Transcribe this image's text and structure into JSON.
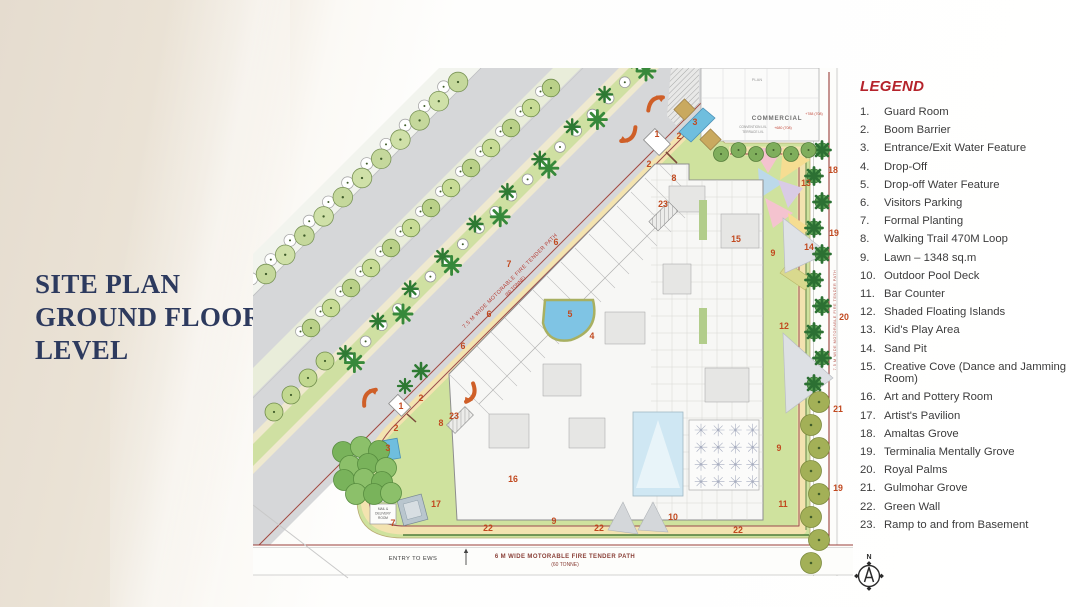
{
  "title": {
    "lines": [
      "SITE PLAN",
      "GROUND FLOOR",
      "LEVEL"
    ]
  },
  "legend": {
    "title": "LEGEND",
    "items": [
      "Guard Room",
      "Boom Barrier",
      "Entrance/Exit Water Feature",
      "Drop-Off",
      "Drop-off Water Feature",
      "Visitors Parking",
      "Formal Planting",
      "Walking Trail 470M Loop",
      "Lawn – 1348 sq.m",
      "Outdoor Pool Deck",
      "Bar Counter",
      "Shaded Floating Islands",
      "Kid's Play Area",
      "Sand Pit",
      "Creative Cove (Dance and Jamming Room)",
      "Art and Pottery Room",
      "Artist's Pavilion",
      "Amaltas Grove",
      "Terminalia Mentally Grove",
      "Royal Palms",
      "Gulmohar Grove",
      "Green Wall",
      "Ramp to and from Basement"
    ]
  },
  "plan": {
    "annotations": {
      "commercial": "COMMERCIAL",
      "convention": "CONVENTION LVL",
      "terrace": "TERRACE LVL",
      "plan_small": "PLAN",
      "elev_1": "+788 (708)",
      "elev_2": "+680 (708)",
      "fire_diag_1": "7.5 M WIDE MOTORABLE FIRE TENDER PATH",
      "fire_diag_2": "(60 TONNE)",
      "fire_right": "7.5 M WIDE MOTORABLE FIRE TENDER PATH",
      "fire_bottom_1": "6 M WIDE MOTORABLE FIRE TENDER PATH",
      "fire_bottom_2": "(60 TONNE)",
      "entry_ews": "ENTRY TO EWS",
      "maint": "MAINT.",
      "mail_1": "MAIL &",
      "mail_2": "DELIVERY",
      "mail_3": "ROOM",
      "north": "N"
    },
    "markers": [
      {
        "n": "1",
        "x": 404,
        "y": 66
      },
      {
        "n": "1",
        "x": 148,
        "y": 338
      },
      {
        "n": "2",
        "x": 426,
        "y": 68
      },
      {
        "n": "2",
        "x": 396,
        "y": 96
      },
      {
        "n": "2",
        "x": 168,
        "y": 330
      },
      {
        "n": "2",
        "x": 143,
        "y": 360
      },
      {
        "n": "3",
        "x": 442,
        "y": 54
      },
      {
        "n": "3",
        "x": 135,
        "y": 380
      },
      {
        "n": "4",
        "x": 339,
        "y": 268
      },
      {
        "n": "5",
        "x": 317,
        "y": 246
      },
      {
        "n": "6",
        "x": 303,
        "y": 174
      },
      {
        "n": "6",
        "x": 236,
        "y": 246
      },
      {
        "n": "6",
        "x": 210,
        "y": 278
      },
      {
        "n": "7",
        "x": 256,
        "y": 196
      },
      {
        "n": "7",
        "x": 140,
        "y": 455
      },
      {
        "n": "8",
        "x": 421,
        "y": 110
      },
      {
        "n": "8",
        "x": 188,
        "y": 355
      },
      {
        "n": "9",
        "x": 520,
        "y": 185
      },
      {
        "n": "9",
        "x": 526,
        "y": 380
      },
      {
        "n": "9",
        "x": 301,
        "y": 453
      },
      {
        "n": "10",
        "x": 420,
        "y": 449
      },
      {
        "n": "11",
        "x": 530,
        "y": 436
      },
      {
        "n": "12",
        "x": 531,
        "y": 258
      },
      {
        "n": "13",
        "x": 553,
        "y": 115
      },
      {
        "n": "14",
        "x": 556,
        "y": 179
      },
      {
        "n": "15",
        "x": 483,
        "y": 171
      },
      {
        "n": "16",
        "x": 260,
        "y": 411
      },
      {
        "n": "17",
        "x": 183,
        "y": 436
      },
      {
        "n": "18",
        "x": 580,
        "y": 102
      },
      {
        "n": "19",
        "x": 581,
        "y": 165
      },
      {
        "n": "19",
        "x": 585,
        "y": 420
      },
      {
        "n": "20",
        "x": 591,
        "y": 249
      },
      {
        "n": "21",
        "x": 585,
        "y": 341
      },
      {
        "n": "22",
        "x": 235,
        "y": 460
      },
      {
        "n": "22",
        "x": 346,
        "y": 460
      },
      {
        "n": "22",
        "x": 485,
        "y": 462
      },
      {
        "n": "23",
        "x": 410,
        "y": 136
      },
      {
        "n": "23",
        "x": 201,
        "y": 348
      }
    ]
  },
  "colors": {
    "title_navy": "#2d3a5e",
    "legend_red": "#b5232b",
    "marker_orange": "#c1491f",
    "lawn_green": "#cfe29e",
    "water_blue": "#6fbede",
    "road_gray": "#d6d7d9",
    "path_cream": "#efe9cf",
    "tree_green": "#7fae5c"
  }
}
